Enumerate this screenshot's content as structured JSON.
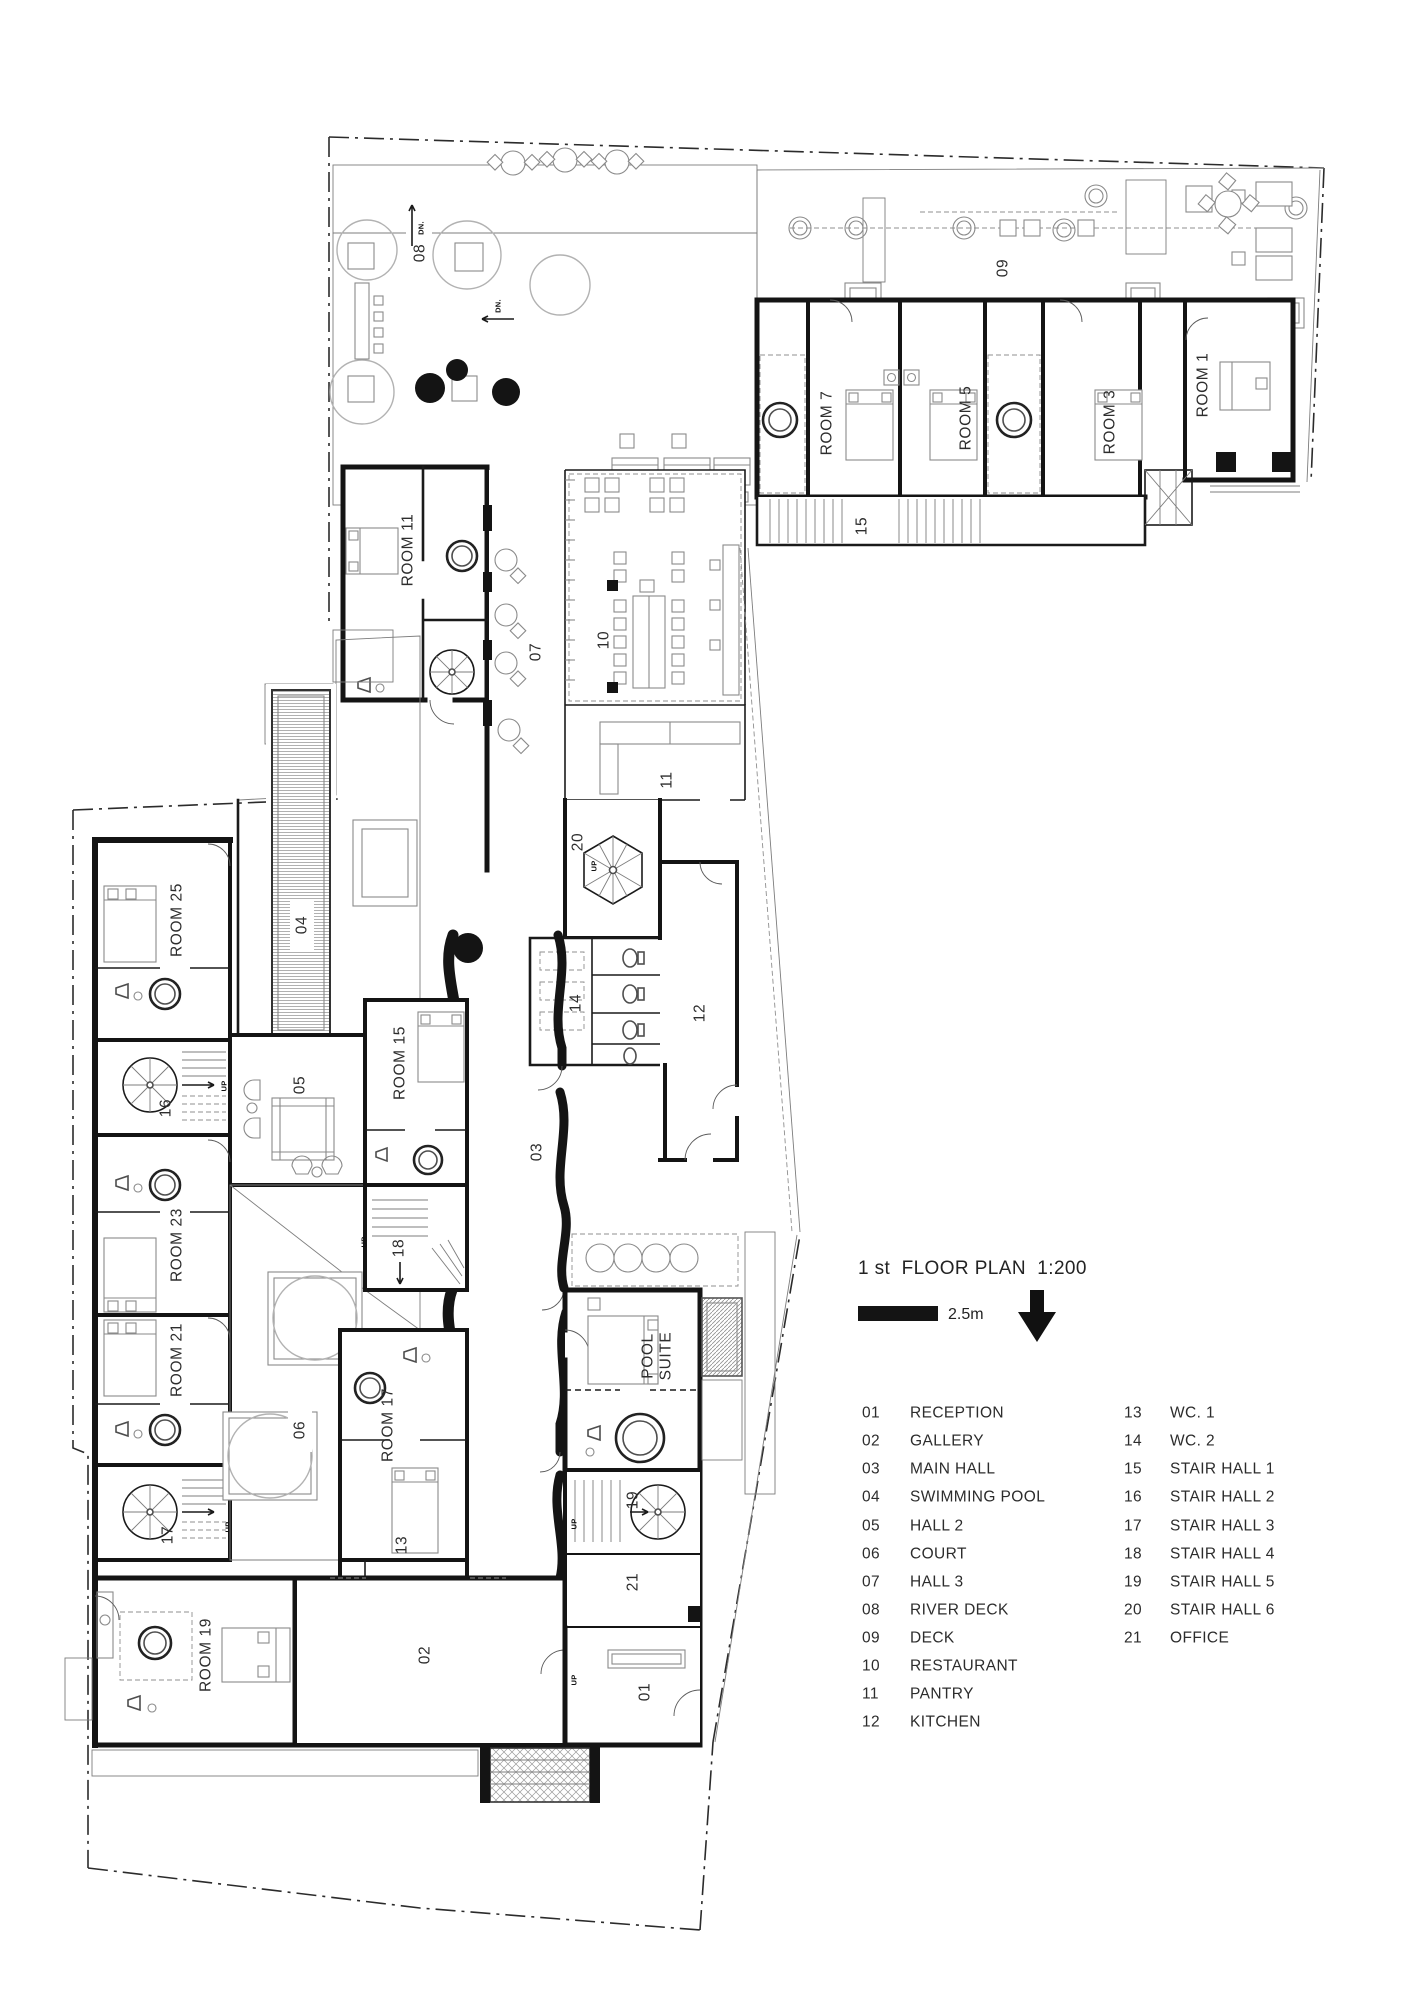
{
  "title": {
    "text": "1 st  FLOOR PLAN  1:200"
  },
  "scale_bar": {
    "label": "2.5m"
  },
  "plan": {
    "rooms": {
      "r1": "ROOM 1",
      "r3": "ROOM 3",
      "r5": "ROOM 5",
      "r7": "ROOM 7",
      "r11": "ROOM 11",
      "r15": "ROOM 15",
      "r17": "ROOM 17",
      "r19": "ROOM 19",
      "r21": "ROOM 21",
      "r23": "ROOM 23",
      "r25": "ROOM 25"
    },
    "suite": {
      "line1": "POOL",
      "line2": "SUITE"
    },
    "spaces": {
      "s01": "01",
      "s02": "02",
      "s03": "03",
      "s04": "04",
      "s05": "05",
      "s06": "06",
      "s07": "07",
      "s08": "08",
      "s09": "09",
      "s10": "10",
      "s11": "11",
      "s12": "12",
      "s13": "13",
      "s14": "14",
      "s15": "15",
      "s16": "16",
      "s17": "17",
      "s18": "18",
      "s19": "19",
      "s20": "20",
      "s21": "21"
    },
    "annotations": {
      "up": "UP",
      "dn": "DN."
    }
  },
  "legend": {
    "items": [
      {
        "num": "01",
        "name": "RECEPTION"
      },
      {
        "num": "02",
        "name": "GALLERY"
      },
      {
        "num": "03",
        "name": "MAIN HALL"
      },
      {
        "num": "04",
        "name": "SWIMMING POOL"
      },
      {
        "num": "05",
        "name": "HALL 2"
      },
      {
        "num": "06",
        "name": "COURT"
      },
      {
        "num": "07",
        "name": "HALL 3"
      },
      {
        "num": "08",
        "name": "RIVER DECK"
      },
      {
        "num": "09",
        "name": "DECK"
      },
      {
        "num": "10",
        "name": "RESTAURANT"
      },
      {
        "num": "11",
        "name": "PANTRY"
      },
      {
        "num": "12",
        "name": "KITCHEN"
      },
      {
        "num": "13",
        "name": "WC. 1"
      },
      {
        "num": "14",
        "name": "WC. 2"
      },
      {
        "num": "15",
        "name": "STAIR HALL 1"
      },
      {
        "num": "16",
        "name": "STAIR HALL 2"
      },
      {
        "num": "17",
        "name": "STAIR HALL 3"
      },
      {
        "num": "18",
        "name": "STAIR HALL 4"
      },
      {
        "num": "19",
        "name": "STAIR HALL 5"
      },
      {
        "num": "20",
        "name": "STAIR HALL 6"
      },
      {
        "num": "21",
        "name": "OFFICE"
      }
    ]
  },
  "colors": {
    "ink": "#141414",
    "hatch": "#a8a8a8",
    "paver": "#cccccc"
  }
}
